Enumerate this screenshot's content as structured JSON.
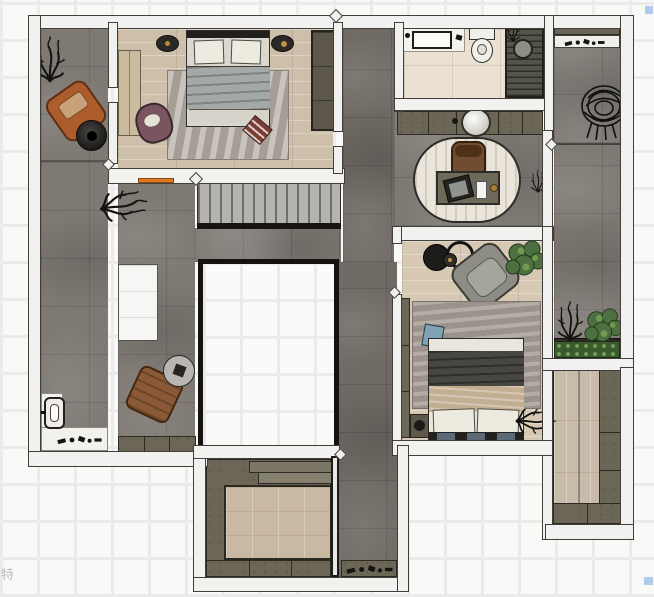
{
  "canvas": {
    "width": 654,
    "height": 597
  },
  "watermark": {
    "text": "特"
  },
  "palette": {
    "wall": "#f1f1ef",
    "wallEdge": "#413f3b",
    "floorGray": "#7e7973",
    "floorGrayDark": "#6f6a64",
    "woodMaster": "#cdbfa9",
    "woodBR2": "#d6c8b3",
    "woodCloset": "#c9bba9",
    "marbleBath": "#eae1d2",
    "marbleWhite": "#f3f1ec",
    "olive": "#6b6656",
    "stairTread": "#b5b3af",
    "stairLine": "#6f6d69",
    "rugMaster": "#b4aca4",
    "rugBR2": "#a8a097",
    "duvetMaster": "#a4a9a7",
    "duvetBR2": "#474641",
    "blanketBR2": "#c4ae92",
    "pillowWhite": "#edebdf",
    "chairOrange": "#ad5c2b",
    "chairMauve": "#7a5560",
    "chairBrown": "#8a5a38",
    "chairStudy": "#714c30",
    "chairGrayBR2": "#8e8d85",
    "deskOlive": "#6e6959",
    "plantGreen": "#4c7040",
    "soil": "#2d2a24",
    "pillowBlue": "#7fa2b4",
    "accentOrange": "#e07820",
    "voidEdge": "#141311"
  },
  "scene": {
    "rooms": [
      {
        "id": "left-balcony",
        "floor": "gray-tile"
      },
      {
        "id": "master-bedroom",
        "floor": "wood"
      },
      {
        "id": "living-landing",
        "floor": "gray-tile"
      },
      {
        "id": "bathroom",
        "floor": "marble"
      },
      {
        "id": "study-landing",
        "floor": "gray-tile"
      },
      {
        "id": "right-balcony",
        "floor": "gray-tile"
      },
      {
        "id": "bedroom-2",
        "floor": "wood"
      },
      {
        "id": "planter-terrace",
        "floor": "gray-tile"
      },
      {
        "id": "walk-in-closet",
        "floor": "wood"
      },
      {
        "id": "tatami-room",
        "floor": "wood-platform"
      },
      {
        "id": "entry-corridor",
        "floor": "gray-tile"
      },
      {
        "id": "floor-void",
        "floor": "open-to-below"
      }
    ],
    "furniture": [
      "double-bed-master",
      "nightstand-left",
      "nightstand-right",
      "wardrobe-master-left",
      "closet-master-right",
      "rug-master",
      "armchair-mauve",
      "pouf-red",
      "armchair-orange",
      "side-table-black",
      "potted-plant-black",
      "stairs",
      "skylight-small",
      "floor-void",
      "vanity-sink",
      "toilet",
      "shower",
      "console-basin",
      "desk",
      "desk-chair",
      "laptop",
      "oval-rug",
      "hanging-egg-chair",
      "balcony-shelf",
      "armchair-brown",
      "side-table-round",
      "garden-tap",
      "planter-box",
      "reading-chair-gray",
      "round-table-black",
      "ring-table",
      "plant-green",
      "double-bed-2",
      "nightstand-2",
      "rug-bedroom-2",
      "pillow-blue",
      "hedge-planter",
      "closet-cabinets",
      "wood-platform",
      "entry-console"
    ]
  }
}
